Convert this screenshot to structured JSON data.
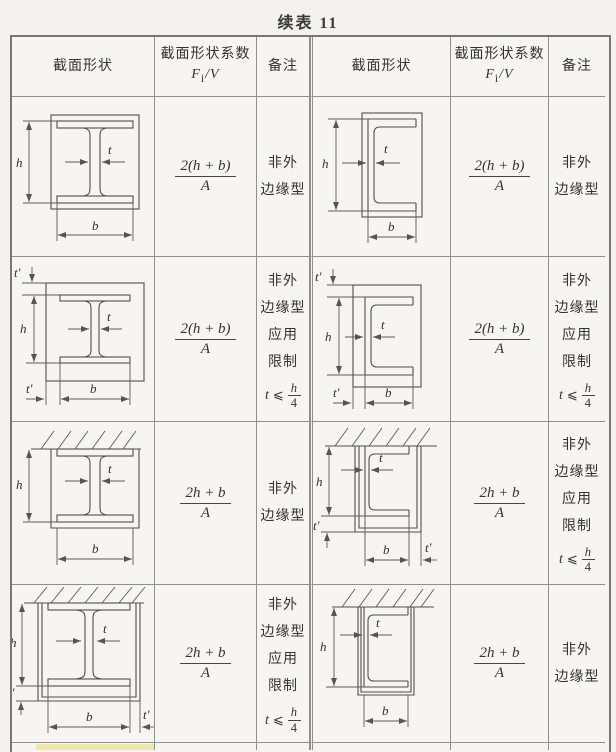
{
  "page": {
    "title": "续表 11"
  },
  "labels": {
    "h": "h",
    "t": "t",
    "b": "b",
    "tp": "t′"
  },
  "header": {
    "shape": "截面形状",
    "coef_title": "截面形状系数",
    "coef_f": "F",
    "coef_sub": "i",
    "coef_rest": "/V",
    "note": "备注"
  },
  "rows": [
    {
      "left": {
        "diagram": "i-beam-box-contour",
        "formula": {
          "num": "2(h + b)",
          "den": "A"
        },
        "note_lines": [
          "非外",
          "边缘型"
        ]
      },
      "right": {
        "diagram": "channel-box-contour",
        "formula": {
          "num": "2(h + b)",
          "den": "A"
        },
        "note_lines": [
          "非外",
          "边缘型"
        ]
      }
    },
    {
      "left": {
        "diagram": "i-beam-board-clad",
        "formula": {
          "num": "2(h + b)",
          "den": "A"
        },
        "note_lines": [
          "非外",
          "边缘型",
          "应用",
          "限制"
        ],
        "limit": {
          "var": "t",
          "rel": "⩽",
          "num": "h",
          "den": "4"
        }
      },
      "right": {
        "diagram": "channel-board-clad",
        "formula": {
          "num": "2(h + b)",
          "den": "A"
        },
        "note_lines": [
          "非外",
          "边缘型",
          "应用",
          "限制"
        ],
        "limit": {
          "var": "t",
          "rel": "⩽",
          "num": "h",
          "den": "4"
        }
      }
    },
    {
      "left": {
        "diagram": "i-beam-ceiling-box",
        "formula": {
          "num": "2h + b",
          "den": "A"
        },
        "note_lines": [
          "非外",
          "边缘型"
        ]
      },
      "right": {
        "diagram": "channel-ceiling-board",
        "formula": {
          "num": "2h + b",
          "den": "A"
        },
        "note_lines": [
          "非外",
          "边缘型",
          "应用",
          "限制"
        ],
        "limit": {
          "var": "t",
          "rel": "⩽",
          "num": "h",
          "den": "4"
        }
      }
    },
    {
      "left": {
        "diagram": "i-beam-ceiling-board",
        "formula": {
          "num": "2h + b",
          "den": "A"
        },
        "note_lines": [
          "非外",
          "边缘型",
          "应用",
          "限制"
        ],
        "limit": {
          "var": "t",
          "rel": "⩽",
          "num": "h",
          "den": "4"
        }
      },
      "right": {
        "diagram": "channel-ceiling-box",
        "formula": {
          "num": "2h + b",
          "den": "A"
        },
        "note_lines": [
          "非外",
          "边缘型"
        ]
      }
    }
  ]
}
